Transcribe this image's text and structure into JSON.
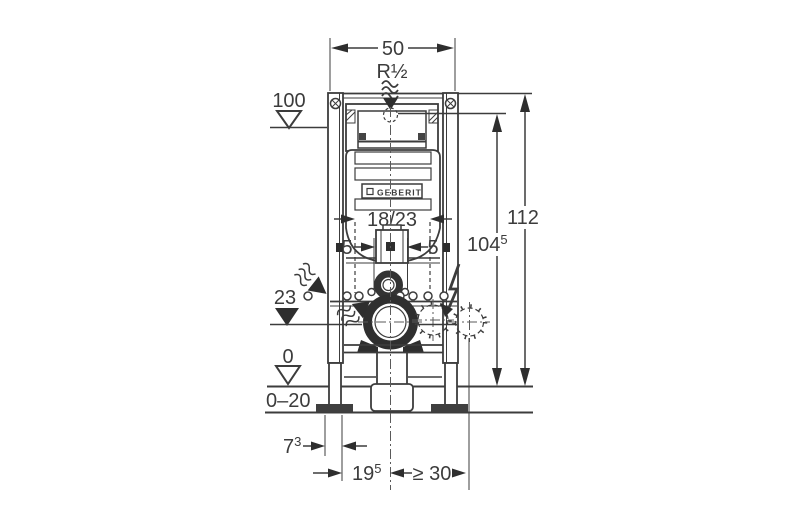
{
  "meta": {
    "type": "technical-installation-drawing",
    "brand": "GEBERIT"
  },
  "colors": {
    "line": "#3c3c3c",
    "arrow": "#2e2e2e",
    "background": "#ffffff"
  },
  "labels": {
    "width": "50",
    "supply_thread": "R½",
    "overall_height": "112",
    "supply_height": {
      "main": "104",
      "sup": "5"
    },
    "duct_depth": "18/23",
    "offset_left": "5",
    "offset_right": "5",
    "level_top": "100",
    "level_outlet": "23",
    "level_floor": "0",
    "floor_buildup": "0–20",
    "foot_depth": {
      "main": "7",
      "sup": "3"
    },
    "outlet_offset": {
      "main": "19",
      "sup": "5"
    },
    "min_clearance": "≥ 30",
    "logo": "GEBERIT"
  },
  "icons": {
    "water_supply": "squiggle-arrow-down",
    "water_inlet_left": "squiggle-arrow-right",
    "water_inlet_inner": "squiggle-arrow-up-right",
    "electrical": "lightning-bolt-arrow",
    "level_open": "open-triangle",
    "level_filled": "filled-triangle"
  }
}
